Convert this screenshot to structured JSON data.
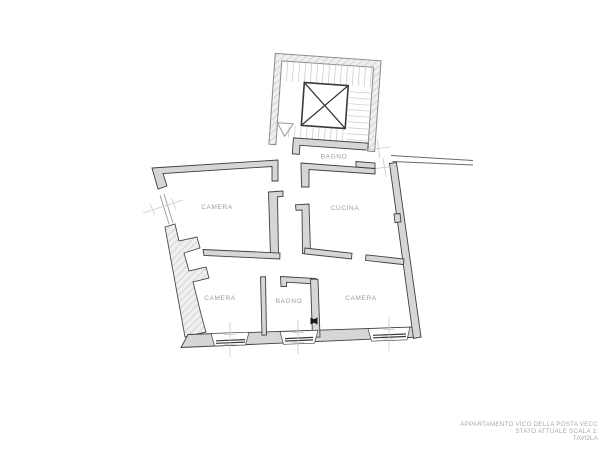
{
  "page": {
    "background_color": "#ffffff",
    "drawing_type": "architectural-floor-plan"
  },
  "floor_plan": {
    "rooms": [
      {
        "name": "bagno-top",
        "label": "BAGNO"
      },
      {
        "name": "camera-top-left",
        "label": "CAMERA"
      },
      {
        "name": "cucina",
        "label": "CUCINA"
      },
      {
        "name": "camera-bottom-left",
        "label": "CAMERA"
      },
      {
        "name": "bagno-bottom",
        "label": "BAGNO"
      },
      {
        "name": "camera-bottom-right",
        "label": "CAMERA"
      }
    ],
    "icons": [
      {
        "name": "elevator-shaft-x-icon"
      },
      {
        "name": "stair-direction-triangle-icon"
      },
      {
        "name": "door-hinge-icon"
      }
    ],
    "colors": {
      "wall_outline": "#404040",
      "wall_fill": "#d6d6d6",
      "hatch_line": "#b9b9b9",
      "stair_tread": "#c8c8c8",
      "centerline": "#c9c9c9",
      "room_label": "#9c9c9c",
      "title_text": "#a9a9a9"
    }
  },
  "title_block": {
    "line1": "APPARTAMENTO VICO DELLA POSTA VECC",
    "line2": "STATO ATTUALE SCALA 1:",
    "line3": "TAVOLA"
  }
}
